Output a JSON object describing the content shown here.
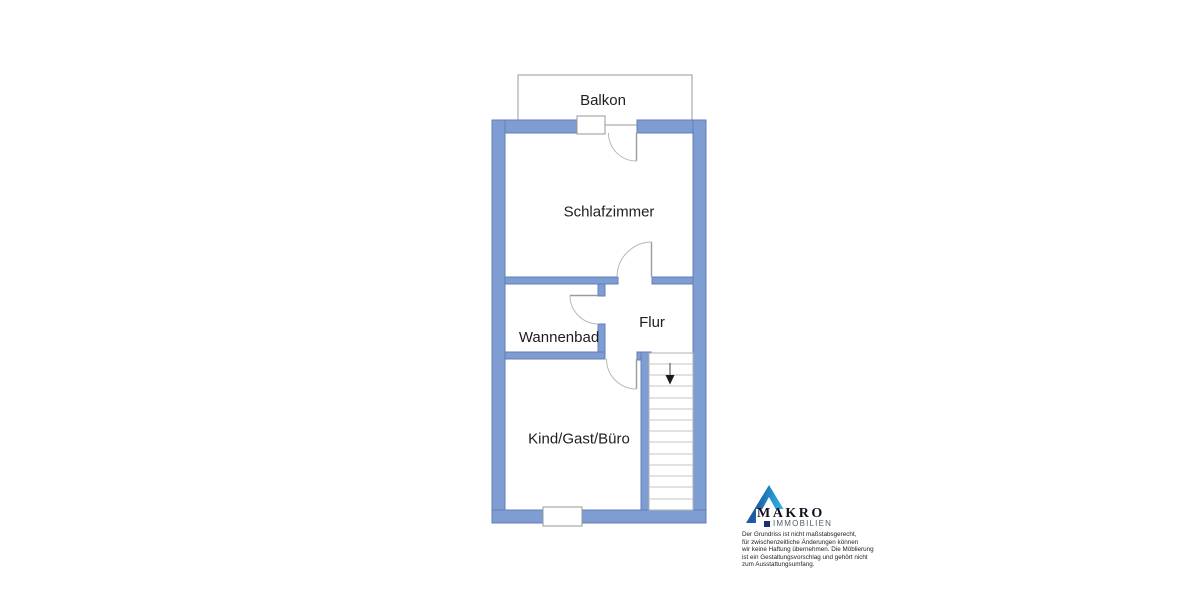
{
  "plan": {
    "balcony_label": "Balkon",
    "rooms": [
      {
        "id": "schlafzimmer",
        "label": "Schlafzimmer"
      },
      {
        "id": "wannenbad",
        "label": "Wannenbad"
      },
      {
        "id": "flur",
        "label": "Flur"
      },
      {
        "id": "kind-gast-buero",
        "label": "Kind/Gast/Büro"
      }
    ]
  },
  "branding": {
    "company": "MAKRO",
    "division": "IMMOBILIEN"
  },
  "disclaimer": {
    "lines": [
      "Der Grundriss ist nicht maßstabsgerecht,",
      "für zwischenzeitliche Änderungen können",
      "wir keine Haftung übernehmen. Die Möblierung",
      "ist ein Gestaltungsvorschlag und gehört nicht",
      "zum Ausstattungsumfang."
    ]
  },
  "colors": {
    "wall_fill": "#7e9ed3",
    "wall_edge": "#647fb5",
    "thin_line_gray": "#a9a9a9",
    "door_line_gray": "#b0b0b0",
    "stair_tread_gray": "#c6c6c6",
    "label_text": "#1e1e1e",
    "logo_dark_blue": "#1d5a9f",
    "logo_cyan": "#36b9ea",
    "logo_square_navy": "#1a3070",
    "logo_company_text": "#101020",
    "logo_division_text": "#4e5d68"
  }
}
